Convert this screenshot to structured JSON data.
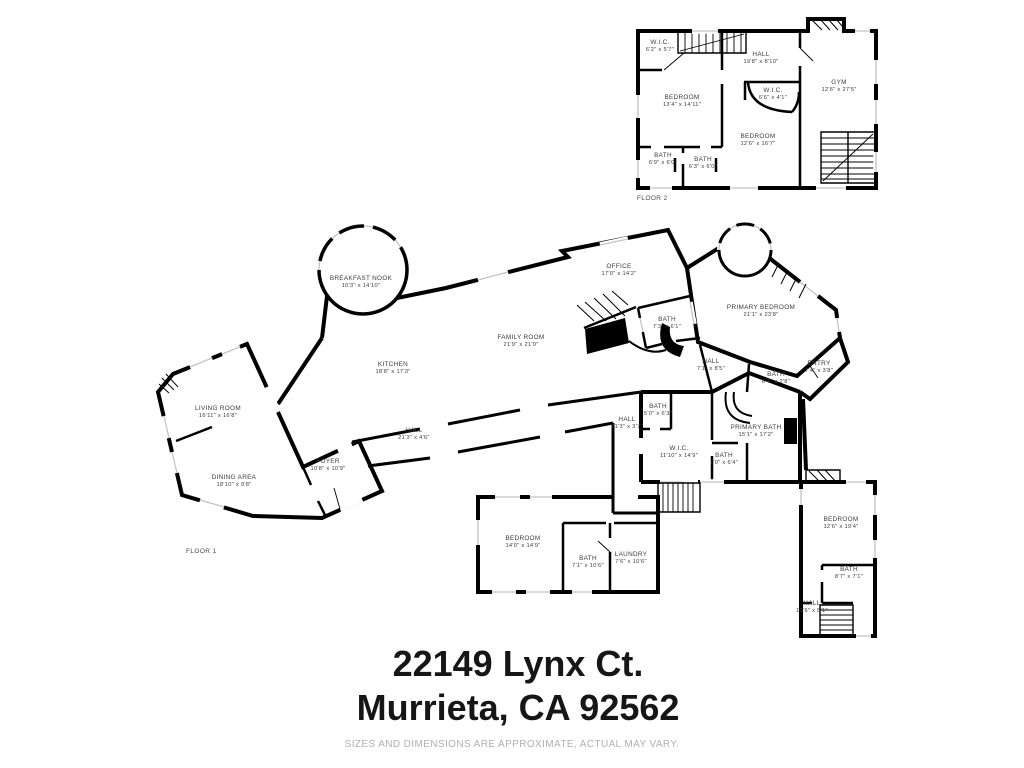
{
  "floor2": {
    "label": "FLOOR 2",
    "rooms": [
      {
        "name": "W.I.C.",
        "dims": "6'2\" x 5'7\""
      },
      {
        "name": "BEDROOM",
        "dims": "13'4\" x 14'11\""
      },
      {
        "name": "HALL",
        "dims": "19'8\" x 8'10\""
      },
      {
        "name": "W.I.C.",
        "dims": "6'6\" x 4'1\""
      },
      {
        "name": "GYM",
        "dims": "12'6\" x 27'5\""
      },
      {
        "name": "BEDROOM",
        "dims": "12'6\" x 16'7\""
      },
      {
        "name": "BATH",
        "dims": "6'9\" x 6'0\""
      },
      {
        "name": "BATH",
        "dims": "6'3\" x 6'0\""
      }
    ]
  },
  "floor1": {
    "label": "FLOOR 1",
    "rooms": [
      {
        "name": "LIVING ROOM",
        "dims": "16'11\" x 16'8\""
      },
      {
        "name": "DINING AREA",
        "dims": "18'10\" x 9'8\""
      },
      {
        "name": "FOYER",
        "dims": "10'8\" x 10'9\""
      },
      {
        "name": "BREAKFAST NOOK",
        "dims": "10'3\" x 14'10\""
      },
      {
        "name": "KITCHEN",
        "dims": "18'8\" x 17'3\""
      },
      {
        "name": "HALL",
        "dims": "21'3\" x 4'6\""
      },
      {
        "name": "FAMILY ROOM",
        "dims": "21'9\" x 21'9\""
      },
      {
        "name": "OFFICE",
        "dims": "17'0\" x 14'2\""
      },
      {
        "name": "BATH",
        "dims": "7'3\" x 6'1\""
      },
      {
        "name": "PRIMARY BEDROOM",
        "dims": "21'1\" x 23'8\""
      },
      {
        "name": "HALL",
        "dims": "7'1\" x 8'5\""
      },
      {
        "name": "BATH",
        "dims": "6'4\" x 2'8\""
      },
      {
        "name": "ENTRY",
        "dims": "7'4\" x 3'8\""
      },
      {
        "name": "HALL",
        "dims": "21'3\" x 3'7\""
      },
      {
        "name": "BATH",
        "dims": "5'0\" x 6'3\""
      },
      {
        "name": "W.I.C.",
        "dims": "11'10\" x 14'9\""
      },
      {
        "name": "PRIMARY BATH",
        "dims": "15'1\" x 17'2\""
      },
      {
        "name": "BATH",
        "dims": "7'0\" x 6'4\""
      },
      {
        "name": "BEDROOM",
        "dims": "14'0\" x 14'9\""
      },
      {
        "name": "BATH",
        "dims": "7'1\" x 10'6\""
      },
      {
        "name": "LAUNDRY",
        "dims": "7'6\" x 10'6\""
      },
      {
        "name": "BEDROOM",
        "dims": "12'6\" x 19'4\""
      },
      {
        "name": "BATH",
        "dims": "8'7\" x 7'1\""
      },
      {
        "name": "HALL",
        "dims": "12'6\" x 8'1\""
      }
    ]
  },
  "address": {
    "line1": "22149 Lynx Ct.",
    "line2": "Murrieta, CA 92562"
  },
  "disclaimer": "SIZES AND DIMENSIONS ARE APPROXIMATE, ACTUAL MAY VARY.",
  "colors": {
    "background": "#ffffff",
    "wall": "#000000",
    "window_marks": "#c4c4c4",
    "room_label": "#3c3c3c",
    "floor_label": "#4a4a4a",
    "address_text": "#161616",
    "disclaimer_text": "#b0b0b0"
  }
}
